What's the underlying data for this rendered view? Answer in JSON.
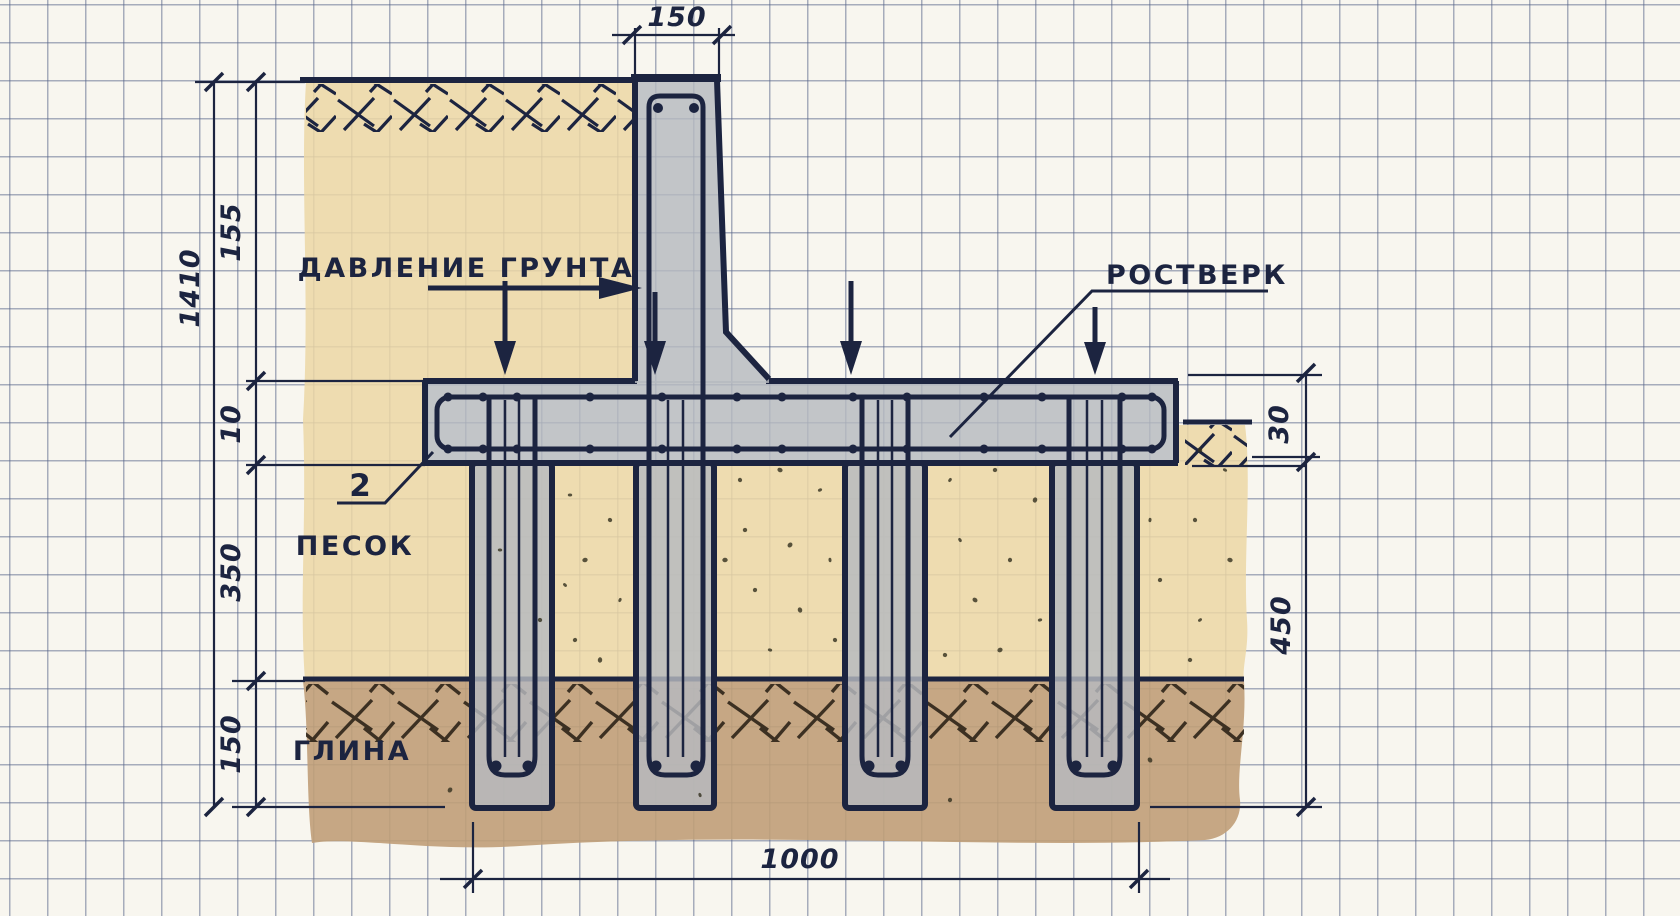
{
  "drawing": {
    "title": "Свайный фундамент с ростверком (схема)",
    "labels": {
      "soil_pressure": "ДАВЛЕНИЕ ГРУНТА",
      "grillage": "РОСТВЕРК",
      "sand": "ПЕСОК",
      "clay": "ГЛИНА",
      "callout_2": "2"
    },
    "dimensions": {
      "top_width": "150",
      "left_total": "1410",
      "left_wall_height": "155",
      "left_grillage_thickness": "10",
      "left_sand_depth": "350",
      "left_clay_depth": "150",
      "right_embedment": "30",
      "right_depth": "450",
      "bottom_span": "1000"
    },
    "colors": {
      "paper": "#f8f6ef",
      "grid_line": "#566288",
      "ink": "#1c2440",
      "sand": "#ecd7a4",
      "clay": "#c09e78",
      "concrete": "#b6bac0",
      "clay_hatch": "#2e2417"
    }
  }
}
